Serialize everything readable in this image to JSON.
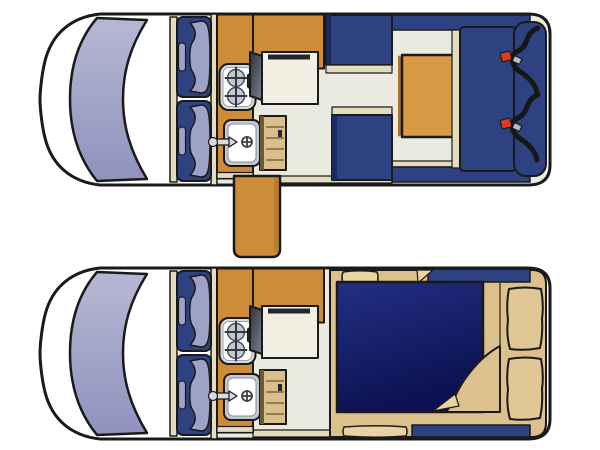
{
  "figure": {
    "kind": "campervan-floorplan-diagram",
    "views": [
      "day-layout",
      "night-layout"
    ]
  },
  "colors": {
    "outline": "#1a1a1a",
    "van_white": "#ffffff",
    "floor_cream": "#EAEAE0",
    "wall_beige": "#E4DCBF",
    "counter_orange": "#CE8C39",
    "table_orange": "#D89A45",
    "orange_shadow": "#A87326",
    "seat_navy": "#2E4180",
    "navy_dark": "#1B2A5E",
    "windshield_top": "#B6B8D3",
    "windshield_bottom": "#8F92BE",
    "lavender": "#9FA2C6",
    "steel_light": "#D8DBE1",
    "steel_mid": "#C2C7D1",
    "white": "#FFFFFF",
    "appliance_dark": "#23272F",
    "cabinet_face": "#F2EFE3",
    "cabinet_dark_top": "#2E333D",
    "cabinet_dark_bottom": "#7A8090",
    "wood_tan": "#D9BF8C",
    "wood_dark_edge": "#6B5B36",
    "bed_tan": "#DCC18C",
    "bed_tan_light": "#E7D3A4",
    "pillow_tan": "#E0C795",
    "mattress_top": "#232F85",
    "mattress_bottom": "#0B1150",
    "belt_black": "#161616",
    "buckle_red": "#E03A1E",
    "buckle_gray": "#B9BEC9"
  }
}
